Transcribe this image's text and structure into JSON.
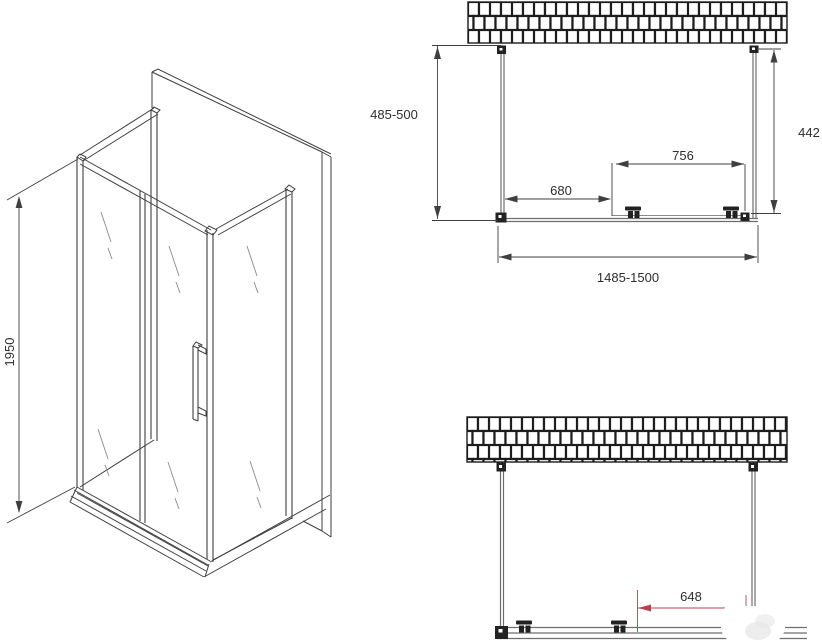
{
  "isometric": {
    "height": "1950"
  },
  "plan": {
    "left_depth": "485-500",
    "right_depth": "442",
    "door_width": "756",
    "fixed_width": "680",
    "total_width": "1485-1500"
  },
  "front": {
    "opening_width": "648"
  },
  "colors": {
    "line": "#3f3f3f",
    "profile": "#6e6e6e",
    "accent_red": "#b5404e",
    "background": "#ffffff"
  }
}
